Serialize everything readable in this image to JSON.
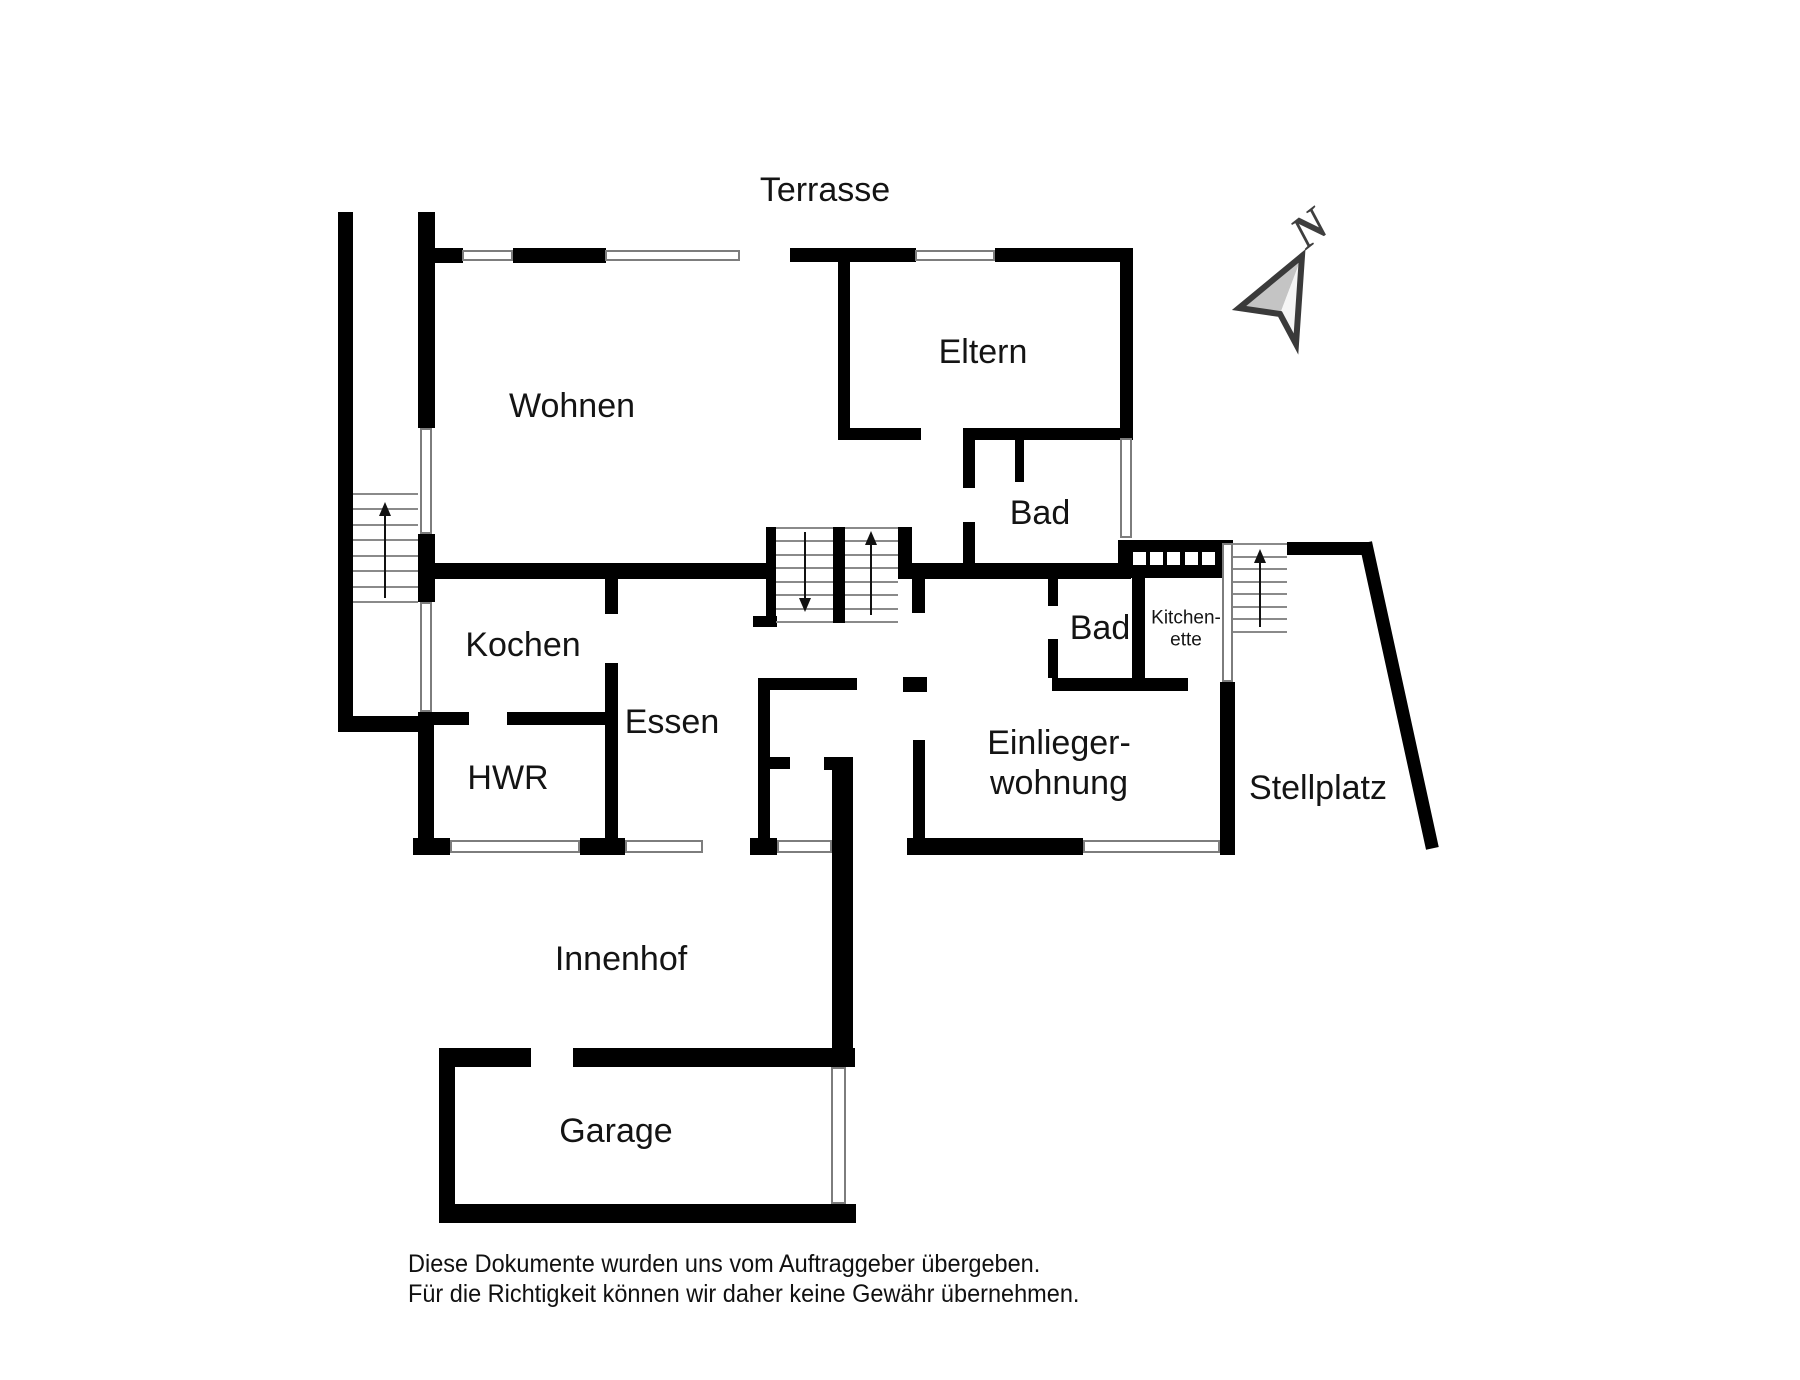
{
  "title": "Grundriss Erdgeschoss",
  "canvas": {
    "width": 1800,
    "height": 1380,
    "background": "#ffffff"
  },
  "colors": {
    "wall": "#000000",
    "window_border": "#7d7d7d",
    "tread": "#8a8a8a",
    "text": "#141414",
    "compass_letter": "#3f3f3f",
    "compass_outline": "#3a3a3a",
    "compass_facet_dark": "#c4c4c4",
    "compass_facet_light": "#f5f5f5"
  },
  "rooms": [
    {
      "id": "terrasse",
      "label": "Terrasse",
      "cx": 825,
      "cy": 190,
      "size": 34
    },
    {
      "id": "wohnen",
      "label": "Wohnen",
      "cx": 572,
      "cy": 406,
      "size": 34
    },
    {
      "id": "eltern",
      "label": "Eltern",
      "cx": 983,
      "cy": 352,
      "size": 34
    },
    {
      "id": "bad-haupthaus",
      "label": "Bad",
      "cx": 1040,
      "cy": 513,
      "size": 34
    },
    {
      "id": "kochen",
      "label": "Kochen",
      "cx": 523,
      "cy": 645,
      "size": 34
    },
    {
      "id": "essen",
      "label": "Essen",
      "cx": 672,
      "cy": 722,
      "size": 34
    },
    {
      "id": "hwr",
      "label": "HWR",
      "cx": 508,
      "cy": 778,
      "size": 34
    },
    {
      "id": "bad-einlieger",
      "label": "Bad",
      "cx": 1100,
      "cy": 628,
      "size": 34
    },
    {
      "id": "kitchenette",
      "label": "Kitchen-\nette",
      "cx": 1186,
      "cy": 630,
      "size": 19
    },
    {
      "id": "einliegerwohnung",
      "label": "Einlieger-\nwohnung",
      "cx": 1059,
      "cy": 763,
      "size": 34
    },
    {
      "id": "stellplatz",
      "label": "Stellplatz",
      "cx": 1318,
      "cy": 788,
      "size": 34
    },
    {
      "id": "innenhof",
      "label": "Innenhof",
      "cx": 621,
      "cy": 959,
      "size": 34
    },
    {
      "id": "garage",
      "label": "Garage",
      "cx": 616,
      "cy": 1131,
      "size": 34
    }
  ],
  "walls": [
    {
      "x": 338,
      "y": 212,
      "w": 15,
      "h": 520
    },
    {
      "x": 338,
      "y": 716,
      "w": 95,
      "h": 16
    },
    {
      "x": 418,
      "y": 212,
      "w": 17,
      "h": 216
    },
    {
      "x": 418,
      "y": 534,
      "w": 17,
      "h": 68
    },
    {
      "x": 418,
      "y": 712,
      "w": 16,
      "h": 141
    },
    {
      "x": 433,
      "y": 712,
      "w": 36,
      "h": 13
    },
    {
      "x": 507,
      "y": 712,
      "w": 99,
      "h": 13
    },
    {
      "x": 605,
      "y": 712,
      "w": 13,
      "h": 141
    },
    {
      "x": 605,
      "y": 577,
      "w": 13,
      "h": 37
    },
    {
      "x": 605,
      "y": 663,
      "w": 13,
      "h": 62
    },
    {
      "x": 432,
      "y": 248,
      "w": 31,
      "h": 15
    },
    {
      "x": 513,
      "y": 248,
      "w": 93,
      "h": 15
    },
    {
      "x": 790,
      "y": 248,
      "w": 126,
      "h": 14
    },
    {
      "x": 995,
      "y": 248,
      "w": 138,
      "h": 14
    },
    {
      "x": 838,
      "y": 248,
      "w": 12,
      "h": 192
    },
    {
      "x": 1120,
      "y": 248,
      "w": 13,
      "h": 190
    },
    {
      "x": 838,
      "y": 428,
      "w": 83,
      "h": 12
    },
    {
      "x": 963,
      "y": 428,
      "w": 170,
      "h": 12
    },
    {
      "x": 963,
      "y": 440,
      "w": 12,
      "h": 48
    },
    {
      "x": 963,
      "y": 522,
      "w": 12,
      "h": 44
    },
    {
      "x": 1015,
      "y": 440,
      "w": 9,
      "h": 42
    },
    {
      "x": 433,
      "y": 563,
      "w": 333,
      "h": 16
    },
    {
      "x": 898,
      "y": 563,
      "w": 233,
      "h": 16
    },
    {
      "x": 766,
      "y": 527,
      "w": 10,
      "h": 96
    },
    {
      "x": 833,
      "y": 527,
      "w": 12,
      "h": 96
    },
    {
      "x": 898,
      "y": 527,
      "w": 14,
      "h": 50
    },
    {
      "x": 912,
      "y": 563,
      "w": 13,
      "h": 50
    },
    {
      "x": 753,
      "y": 616,
      "w": 24,
      "h": 11
    },
    {
      "x": 903,
      "y": 677,
      "w": 24,
      "h": 15
    },
    {
      "x": 913,
      "y": 740,
      "w": 12,
      "h": 103
    },
    {
      "x": 758,
      "y": 678,
      "w": 12,
      "h": 162
    },
    {
      "x": 758,
      "y": 678,
      "w": 99,
      "h": 12
    },
    {
      "x": 765,
      "y": 757,
      "w": 25,
      "h": 12
    },
    {
      "x": 824,
      "y": 757,
      "w": 28,
      "h": 13
    },
    {
      "x": 832,
      "y": 757,
      "w": 21,
      "h": 310
    },
    {
      "x": 413,
      "y": 838,
      "w": 37,
      "h": 17
    },
    {
      "x": 580,
      "y": 838,
      "w": 45,
      "h": 17
    },
    {
      "x": 750,
      "y": 838,
      "w": 27,
      "h": 17
    },
    {
      "x": 907,
      "y": 838,
      "w": 176,
      "h": 17
    },
    {
      "x": 1220,
      "y": 682,
      "w": 15,
      "h": 173
    },
    {
      "x": 1048,
      "y": 575,
      "w": 10,
      "h": 31
    },
    {
      "x": 1048,
      "y": 639,
      "w": 10,
      "h": 39
    },
    {
      "x": 1052,
      "y": 678,
      "w": 93,
      "h": 13
    },
    {
      "x": 1132,
      "y": 575,
      "w": 13,
      "h": 116
    },
    {
      "x": 1145,
      "y": 678,
      "w": 43,
      "h": 13
    },
    {
      "x": 1118,
      "y": 540,
      "w": 115,
      "h": 38
    },
    {
      "x": 1287,
      "y": 542,
      "w": 84,
      "h": 13
    },
    {
      "x": 439,
      "y": 1048,
      "w": 92,
      "h": 19
    },
    {
      "x": 573,
      "y": 1048,
      "w": 282,
      "h": 19
    },
    {
      "x": 439,
      "y": 1048,
      "w": 16,
      "h": 175
    },
    {
      "x": 439,
      "y": 1204,
      "w": 417,
      "h": 19
    }
  ],
  "windows": [
    {
      "x": 462,
      "y": 250,
      "w": 51,
      "h": 11
    },
    {
      "x": 605,
      "y": 250,
      "w": 135,
      "h": 11
    },
    {
      "x": 915,
      "y": 250,
      "w": 80,
      "h": 11
    },
    {
      "x": 1120,
      "y": 438,
      "w": 12,
      "h": 100
    },
    {
      "x": 420,
      "y": 428,
      "w": 12,
      "h": 106
    },
    {
      "x": 420,
      "y": 602,
      "w": 12,
      "h": 110
    },
    {
      "x": 450,
      "y": 840,
      "w": 130,
      "h": 13
    },
    {
      "x": 625,
      "y": 840,
      "w": 78,
      "h": 13
    },
    {
      "x": 777,
      "y": 840,
      "w": 55,
      "h": 13
    },
    {
      "x": 1083,
      "y": 840,
      "w": 137,
      "h": 13
    },
    {
      "x": 831,
      "y": 1067,
      "w": 15,
      "h": 137
    },
    {
      "x": 1222,
      "y": 543,
      "w": 11,
      "h": 139
    }
  ],
  "kitchen_squares": {
    "y": 552,
    "size": 13,
    "xs": [
      1133,
      1150,
      1167,
      1185,
      1202
    ]
  },
  "stairs": [
    {
      "id": "treppe-aussen-west",
      "x": 353,
      "y": 493,
      "w": 65,
      "h": 110,
      "treads": 8
    },
    {
      "id": "treppe-haus-ab",
      "x": 776,
      "y": 527,
      "w": 57,
      "h": 96,
      "treads": 8
    },
    {
      "id": "treppe-haus-auf",
      "x": 845,
      "y": 527,
      "w": 53,
      "h": 96,
      "treads": 8
    },
    {
      "id": "treppe-aussen-ost",
      "x": 1233,
      "y": 543,
      "w": 54,
      "h": 90,
      "treads": 8
    }
  ],
  "stair_arrows": [
    {
      "x": 385,
      "tail_y": 598,
      "head_y": 502
    },
    {
      "x": 805,
      "tail_y": 532,
      "head_y": 612
    },
    {
      "x": 871,
      "tail_y": 615,
      "head_y": 531
    },
    {
      "x": 1260,
      "tail_y": 627,
      "head_y": 549
    }
  ],
  "boundary_diagonal": {
    "x1": 1367,
    "y1": 549,
    "x2": 1431,
    "y2": 842,
    "stroke_width": 13
  },
  "compass": {
    "letter": "N",
    "letter_x": 1319,
    "letter_y": 240,
    "letter_size": 46,
    "rotation": -38,
    "facet_dark_points": "1302,256 1239,308 1280,314",
    "facet_light_points": "1302,256 1280,314 1296,344",
    "outline_points": "1302,256 1239,308 1280,314 1296,344"
  },
  "disclaimer": {
    "x": 408,
    "y": 1250,
    "size": 25,
    "line1": "Diese Dokumente wurden uns vom Auftraggeber übergeben.",
    "line2": "Für die Richtigkeit können wir daher keine Gewähr übernehmen."
  }
}
